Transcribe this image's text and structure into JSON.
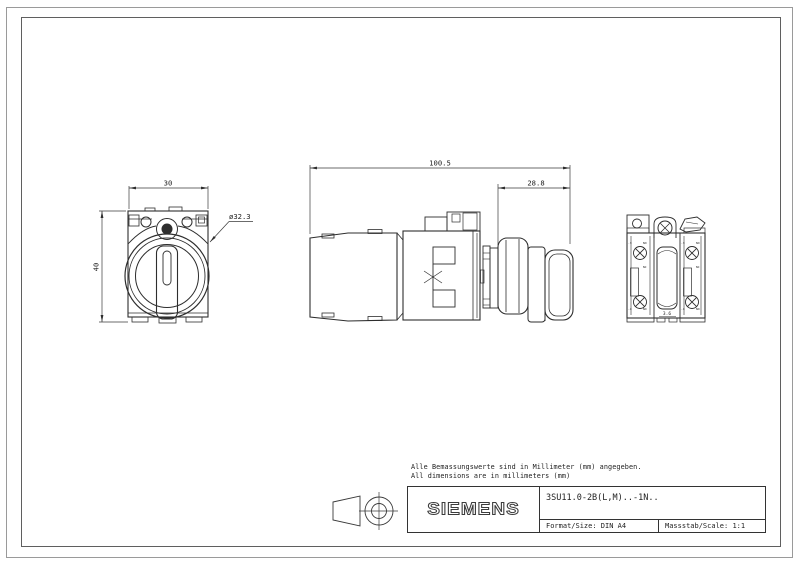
{
  "sheet": {
    "notes": {
      "line1": "Alle Bemassungswerte sind in Millimeter (mm) angegeben.",
      "line2": "All dimensions are in millimeters (mm)"
    },
    "title_block": {
      "brand": "SIEMENS",
      "part_number": "3SU11.0-2B(L,M)..-1N..",
      "format_label": "Format/Size:",
      "format_value": "DIN A4",
      "scale_label": "Massstab/Scale:",
      "scale_value": "1:1"
    },
    "dimensions": {
      "front_width": "30",
      "front_height": "40",
      "front_diameter": "ø32.3",
      "side_overall": "100.5",
      "side_head": "28.8",
      "rear_center": "3.6"
    },
    "rear_labels": {
      "no": "NO",
      "nc": "NC",
      "t3": ".3",
      "t4": ".4"
    },
    "colors": {
      "line": "#2e2e2e",
      "border_outer": "#9a9a9a",
      "border_inner": "#5f5f5f",
      "background": "#ffffff"
    }
  }
}
